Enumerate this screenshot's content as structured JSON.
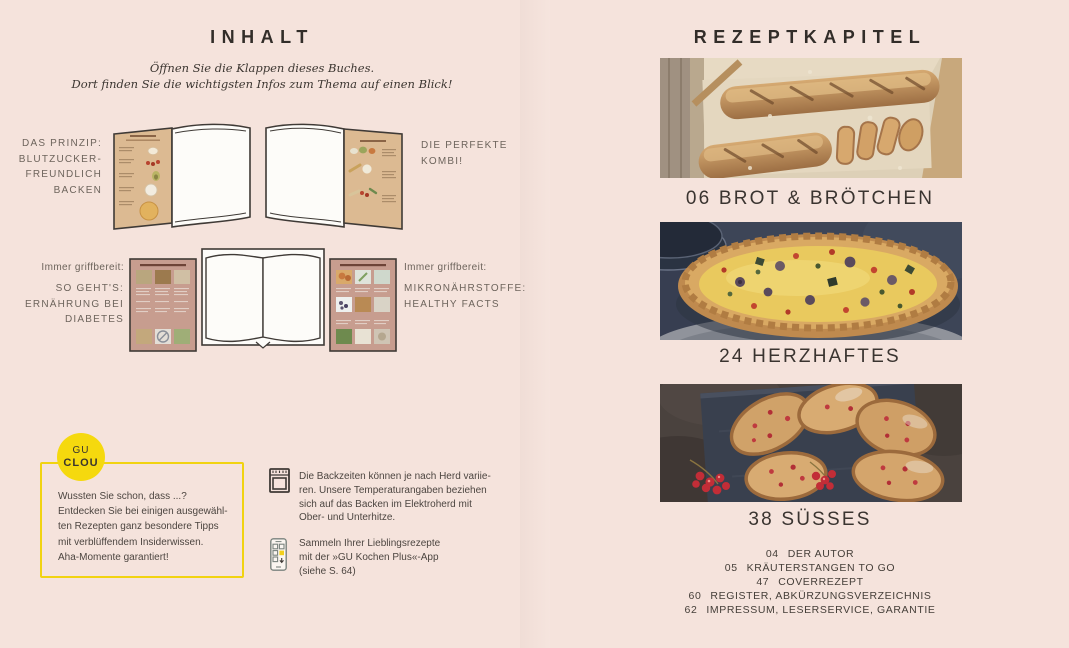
{
  "colors": {
    "background": "#f5e3dc",
    "ink": "#322d29",
    "label_gray": "#6d645c",
    "body_text": "#4c4540",
    "accent_yellow": "#f5d90e",
    "flap_tan": "#dcba92",
    "flap_rose": "#c79d8f"
  },
  "left_page": {
    "title": "INHALT",
    "intro_lines": [
      "Öffnen Sie die Klappen dieses Buches.",
      "Dort finden Sie die wichtigsten Infos zum Thema auf einen Blick!"
    ],
    "row1": {
      "left_label_lines": [
        "DAS PRINZIP:",
        "BLUTZUCKER-",
        "FREUNDLICH",
        "BACKEN"
      ],
      "right_label_lines": [
        "DIE PERFEKTE",
        "KOMBI!"
      ]
    },
    "row2": {
      "left_kicker": "Immer griffbereit:",
      "left_label_lines": [
        "SO GEHT'S:",
        "ERNÄHRUNG BEI",
        "DIABETES"
      ],
      "right_kicker": "Immer griffbereit:",
      "right_label_lines": [
        "MIKRONÄHRSTOFFE:",
        "HEALTHY FACTS"
      ]
    },
    "clou": {
      "badge_line1": "GU",
      "badge_line2": "CLOU",
      "text_lines": [
        "Wussten Sie schon, dass ...?",
        "Entdecken Sie bei einigen ausgewähl-",
        "ten Rezepten ganz besondere Tipps",
        "mit verblüffendem Insiderwissen.",
        "Aha-Momente garantiert!"
      ]
    },
    "notes": [
      {
        "icon": "oven-icon",
        "text_lines": [
          "Die Backzeiten können je nach Herd variie-",
          "ren. Unsere Temperaturangaben beziehen",
          "sich auf das Backen im Elektroherd mit",
          "Ober- und Unterhitze."
        ]
      },
      {
        "icon": "smartphone-app-icon",
        "text_lines": [
          "Sammeln Ihrer Lieblingsrezepte",
          "mit der »GU Kochen Plus«-App",
          "(siehe S. 64)"
        ]
      }
    ]
  },
  "right_page": {
    "title": "REZEPTKAPITEL",
    "chapters": [
      {
        "heading": "06 BROT & BRÖTCHEN",
        "photo": "bread-photo"
      },
      {
        "heading": "24 HERZHAFTES",
        "photo": "quiche-photo"
      },
      {
        "heading": "38 SÜSSES",
        "photo": "currant-cake-photo"
      }
    ],
    "toc": [
      {
        "page": "04",
        "label": "DER AUTOR"
      },
      {
        "page": "05",
        "label": "KRÄUTERSTANGEN TO GO"
      },
      {
        "page": "47",
        "label": "COVERREZEPT"
      },
      {
        "page": "60",
        "label": "REGISTER, ABKÜRZUNGSVERZEICHNIS"
      },
      {
        "page": "62",
        "label": "IMPRESSUM, LESERSERVICE, GARANTIE"
      }
    ]
  }
}
